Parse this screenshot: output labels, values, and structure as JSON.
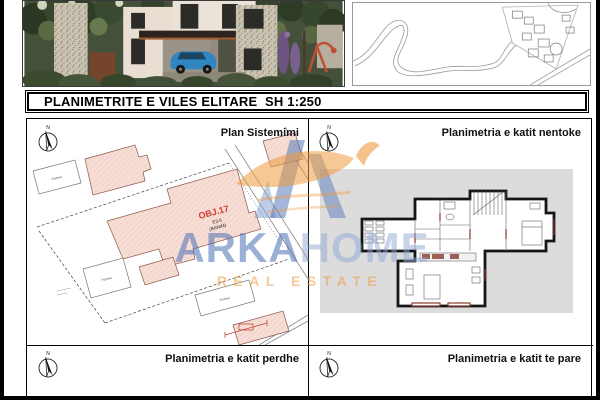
{
  "title_bar": {
    "title": "PLANIMETRITE E VILES ELITARE  SH 1:250"
  },
  "quadrants": {
    "top_left": {
      "label": "Plan Sistemimi"
    },
    "top_right": {
      "label": "Planimetria e katit nentoke"
    },
    "bottom_left": {
      "label": "Planimetria e katit perdhe"
    },
    "bottom_right": {
      "label": "Planimetria e katit te pare"
    }
  },
  "compass": {
    "north": "N"
  },
  "site_plan": {
    "building_id": "OBJ.17",
    "building_code": "E3-5",
    "building_use": "(BANIM)",
    "pool_label": "Pishina"
  },
  "watermark": {
    "brand_part1": "ARKA",
    "brand_part2": "HOME",
    "tagline": "REAL ESTATE"
  },
  "colors": {
    "parcel_pink": "#f6ded6",
    "parcel_outline": "#8d5748",
    "object_red": "#d23b2f",
    "plan_panel_gray": "#dcdcdc",
    "watermark_blue": "#4a6fb5",
    "watermark_light_blue": "#8fa7d4",
    "watermark_orange": "#ef9a3e"
  }
}
